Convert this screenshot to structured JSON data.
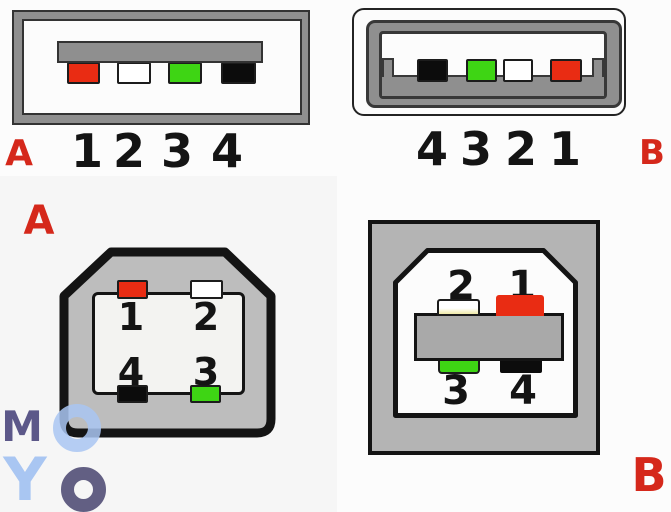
{
  "colors": {
    "canvas_bg": "#fcfcfc",
    "red": "#e92c13",
    "green": "#3ed514",
    "black": "#0c0c0c",
    "white": "#ffffff",
    "frame_gray": "#8f8f8f",
    "plug_gray": "#bdbdbd",
    "socket_gray": "#b4b4b4",
    "bar_gray": "#a9a9a9",
    "label_red": "#d5281b",
    "logo_dark": "#5c5889",
    "logo_dark_alt": "#625f83",
    "logo_light": "#a9c6f2"
  },
  "usb_a_left": {
    "label": "A",
    "pins": [
      {
        "number": "1",
        "color": "red",
        "hex": "#e92c13"
      },
      {
        "number": "2",
        "color": "white",
        "hex": "#ffffff"
      },
      {
        "number": "3",
        "color": "green",
        "hex": "#3ed514"
      },
      {
        "number": "4",
        "color": "black",
        "hex": "#0c0c0c"
      }
    ]
  },
  "usb_a_right": {
    "label": "B",
    "pins": [
      {
        "number": "4",
        "color": "black",
        "hex": "#0c0c0c"
      },
      {
        "number": "3",
        "color": "green",
        "hex": "#3ed514"
      },
      {
        "number": "2",
        "color": "white",
        "hex": "#ffffff"
      },
      {
        "number": "1",
        "color": "red",
        "hex": "#e92c13"
      }
    ]
  },
  "usb_b_left": {
    "label": "A",
    "top_pins": [
      {
        "number": "1",
        "color": "red",
        "hex": "#e92c13"
      },
      {
        "number": "2",
        "color": "white",
        "hex": "#ffffff"
      }
    ],
    "bottom_pins": [
      {
        "number": "4",
        "color": "black",
        "hex": "#0c0c0c"
      },
      {
        "number": "3",
        "color": "green",
        "hex": "#3ed514"
      }
    ]
  },
  "usb_b_right": {
    "label": "B",
    "top_pins": [
      {
        "number": "2",
        "color": "white",
        "hex": "#ffffff"
      },
      {
        "number": "1",
        "color": "red",
        "hex": "#e92c13"
      }
    ],
    "bottom_pins": [
      {
        "number": "3",
        "color": "green",
        "hex": "#3ed514"
      },
      {
        "number": "4",
        "color": "black",
        "hex": "#0c0c0c"
      }
    ]
  },
  "logo": {
    "letter_m": "M",
    "letter_o_top": "O",
    "letter_y": "Y",
    "letter_o_bottom": "O"
  }
}
